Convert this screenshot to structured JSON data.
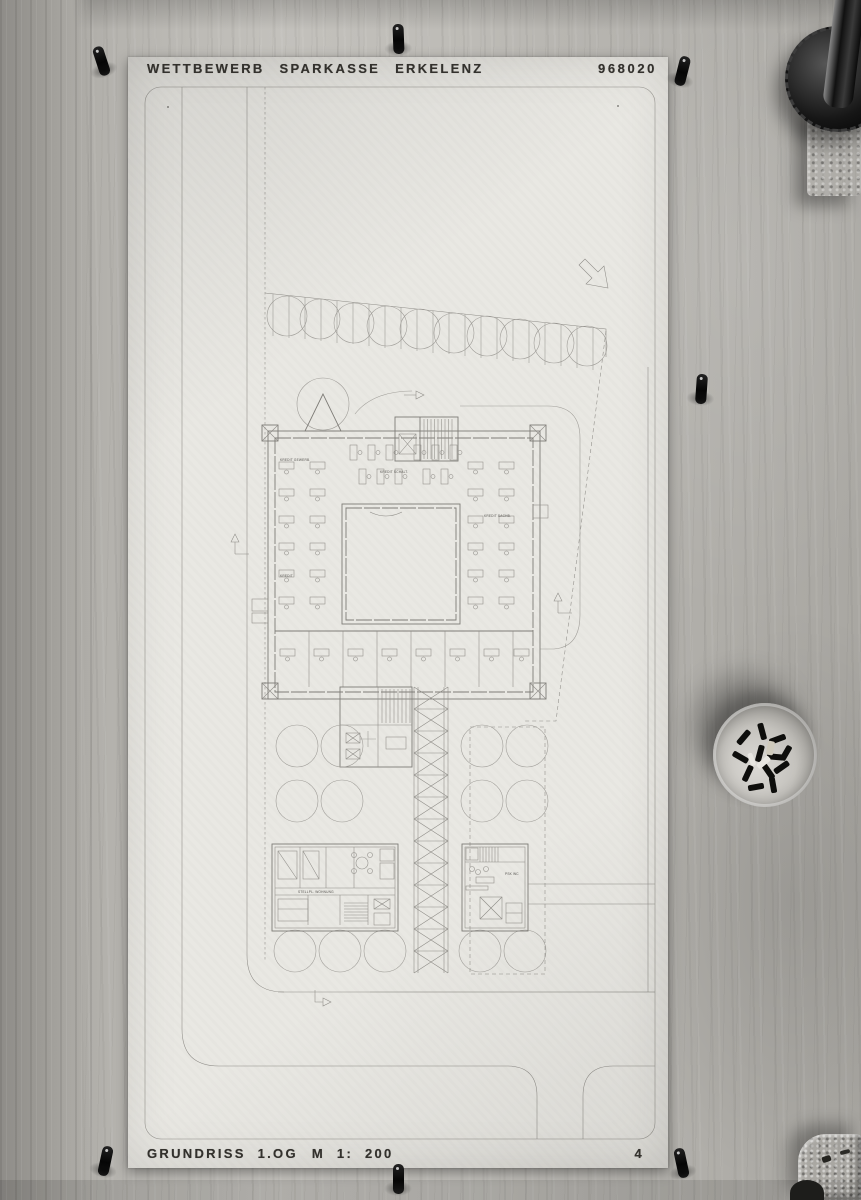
{
  "header": {
    "title": "WETTBEWERB SPARKASSE ERKELENZ",
    "project_number": "968020"
  },
  "footer": {
    "drawing_title": "GRUNDRISS 1.OG",
    "scale": "M 1: 200",
    "sheet_number": "4"
  },
  "plan_labels": {
    "office_left_top": "KREDIT GEWERB.",
    "office_top": "KREDIT SCHALT.",
    "office_right": "KREDIT SACHB.",
    "office_left_mid": "KREDIT",
    "apartment": "STELLPL. WOHNUNG",
    "kiosk": "PSK WC"
  },
  "colors": {
    "paper": "#e9e8e3",
    "wood_light": "#c3c1bc",
    "wood_dark": "#98968f",
    "plan_line": "#8d8b86",
    "ink": "#33312d",
    "pin_black": "#151515"
  }
}
